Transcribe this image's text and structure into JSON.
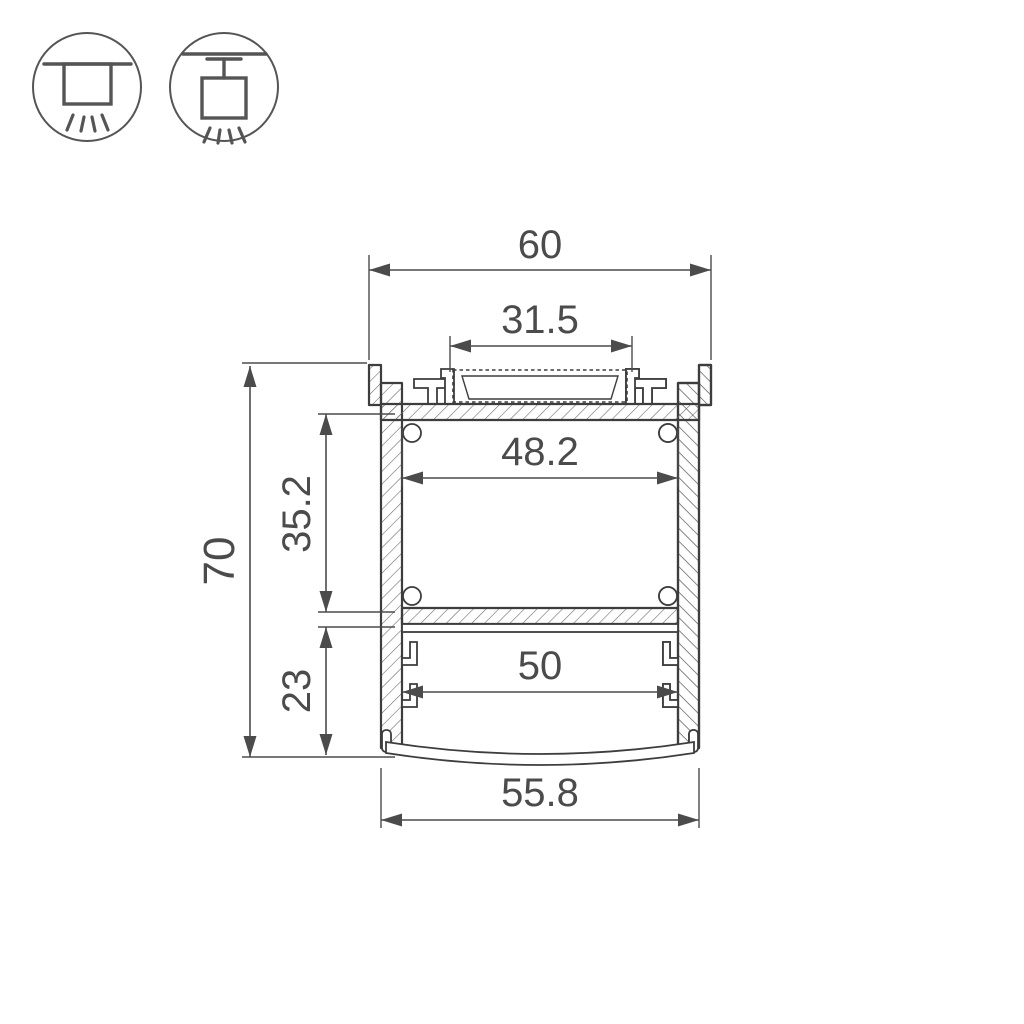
{
  "colors": {
    "background": "#ffffff",
    "outline": "#3d3d3d",
    "dimension": "#4b4b4b",
    "hatch_fill": "#ececec",
    "hatch_line": "#6e6e6e",
    "icon": "#555555"
  },
  "icons": {
    "surface_mount": {
      "name": "surface-mount-luminaire-icon"
    },
    "pendant_mount": {
      "name": "pendant-mount-luminaire-icon"
    }
  },
  "diagram": {
    "type": "technical-cross-section",
    "subject": "Aluminium LED profile cross-section with dimensions (mm)",
    "dimensions": {
      "total_width": {
        "label": "60",
        "value": 60
      },
      "led_recess_width": {
        "label": "31.5",
        "value": 31.5
      },
      "inner_width": {
        "label": "48.2",
        "value": 48.2
      },
      "upper_cavity_height": {
        "label": "35.2",
        "value": 35.2
      },
      "total_height": {
        "label": "70",
        "value": 70
      },
      "lower_cavity_height": {
        "label": "23",
        "value": 23
      },
      "lower_inner_width": {
        "label": "50",
        "value": 50
      },
      "bottom_width": {
        "label": "55.8",
        "value": 55.8
      }
    }
  }
}
